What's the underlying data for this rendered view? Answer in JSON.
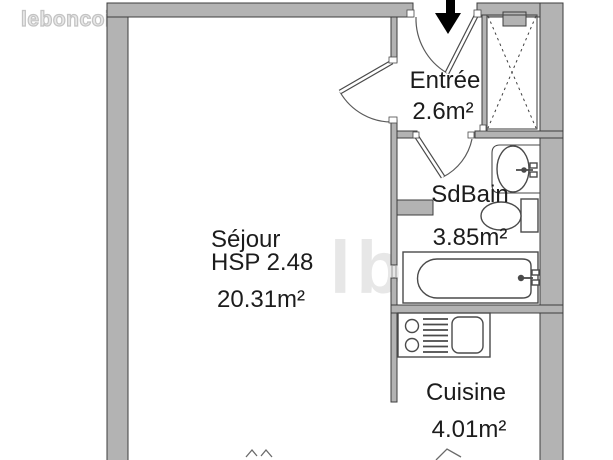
{
  "logo": {
    "text": "leboncoin"
  },
  "watermark": {
    "text": "lbc"
  },
  "plan": {
    "entrance_arrow": "down-arrow",
    "rooms": {
      "entree": {
        "label": "Entrée",
        "area": "2.6m²"
      },
      "sdbain": {
        "label": "SdBain",
        "area": "3.85m²"
      },
      "sejour": {
        "label": "Séjour",
        "height_note": "HSP 2.48",
        "area": "20.31m²"
      },
      "cuisine": {
        "label": "Cuisine",
        "area": "4.01m²"
      }
    },
    "fixtures": [
      "closet-cross",
      "washbasin",
      "toilet",
      "bathtub",
      "cooktop-burners",
      "drainer",
      "kitchen-sink"
    ]
  },
  "colors": {
    "background": "#ffffff",
    "wall_fill": "#b3b3b3",
    "wall_stroke": "#3d3d3d",
    "fixture_stroke": "#4a4a4a",
    "text": "#1c1c1c",
    "watermark": "#e7e7e7",
    "logo": "#c9c9c9",
    "arrow": "#000000"
  }
}
